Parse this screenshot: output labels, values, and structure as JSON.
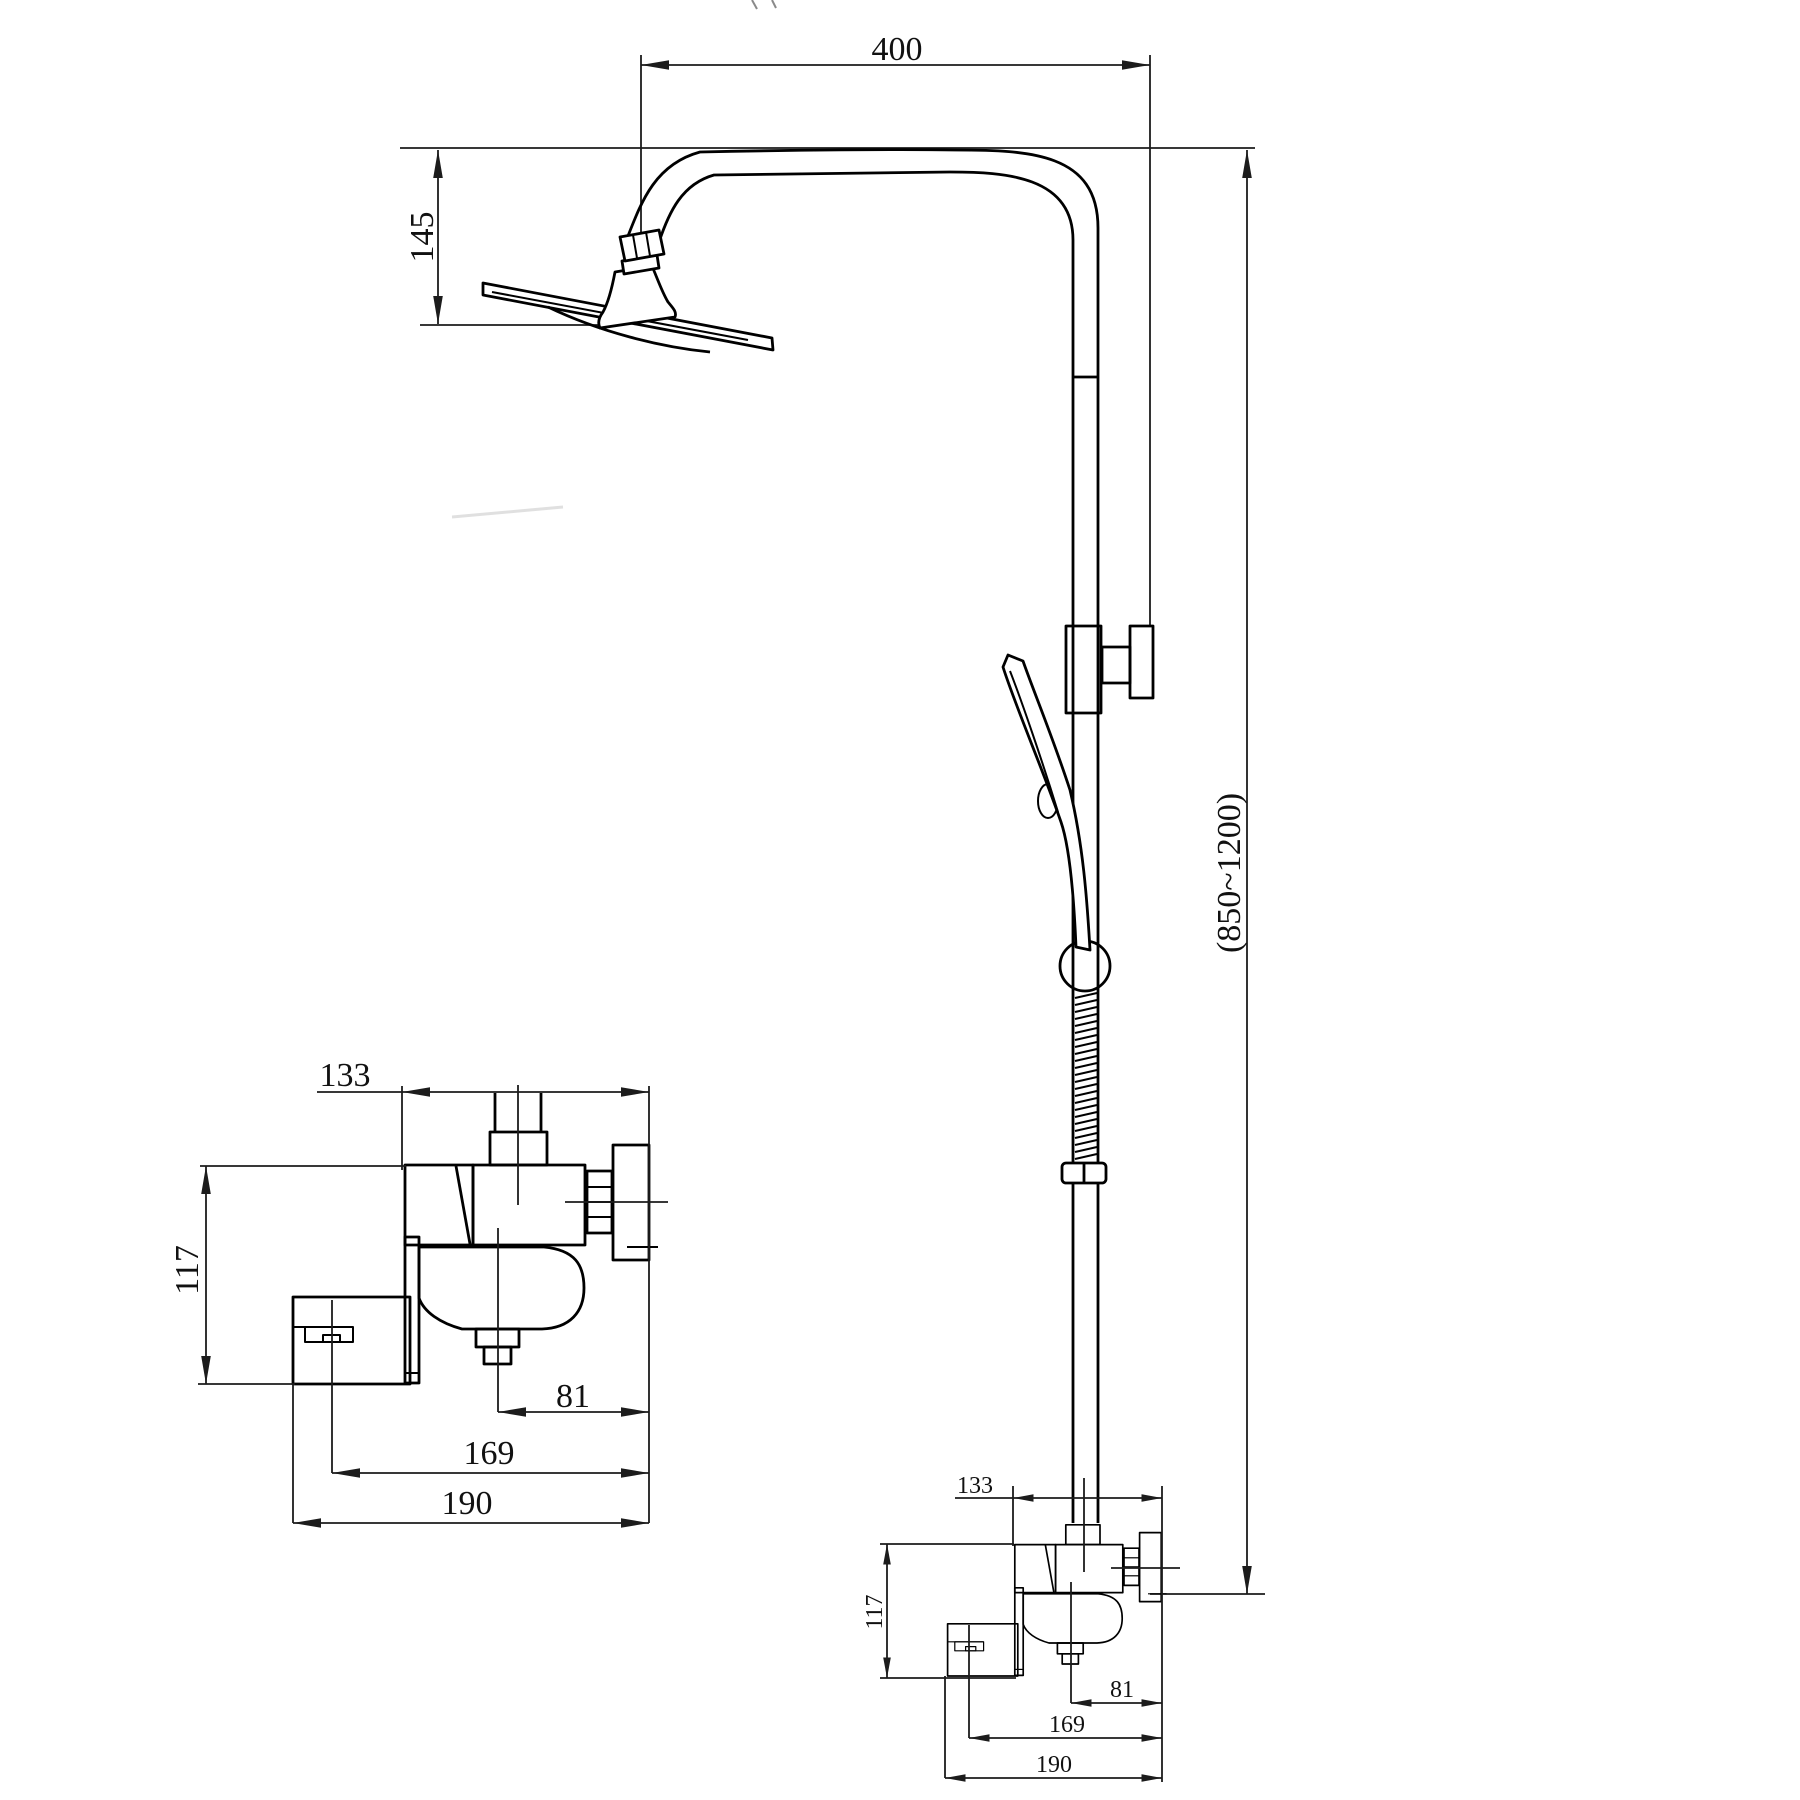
{
  "drawing": {
    "type": "technical-dimension-drawing",
    "subject": "wall-mounted shower column with rain head, hand shower and bath mixer valve",
    "background_color": "#ffffff",
    "line_color": "#000000",
    "dimension_color": "#1c1c1c",
    "dims": {
      "arm_reach": "400",
      "head_drop": "145",
      "column_height_range": "(850~1200)",
      "mixer_width": "133",
      "mixer_height": "117",
      "outlet_offset": "81",
      "diverter_span": "169",
      "mixer_overall_width": "190"
    }
  }
}
